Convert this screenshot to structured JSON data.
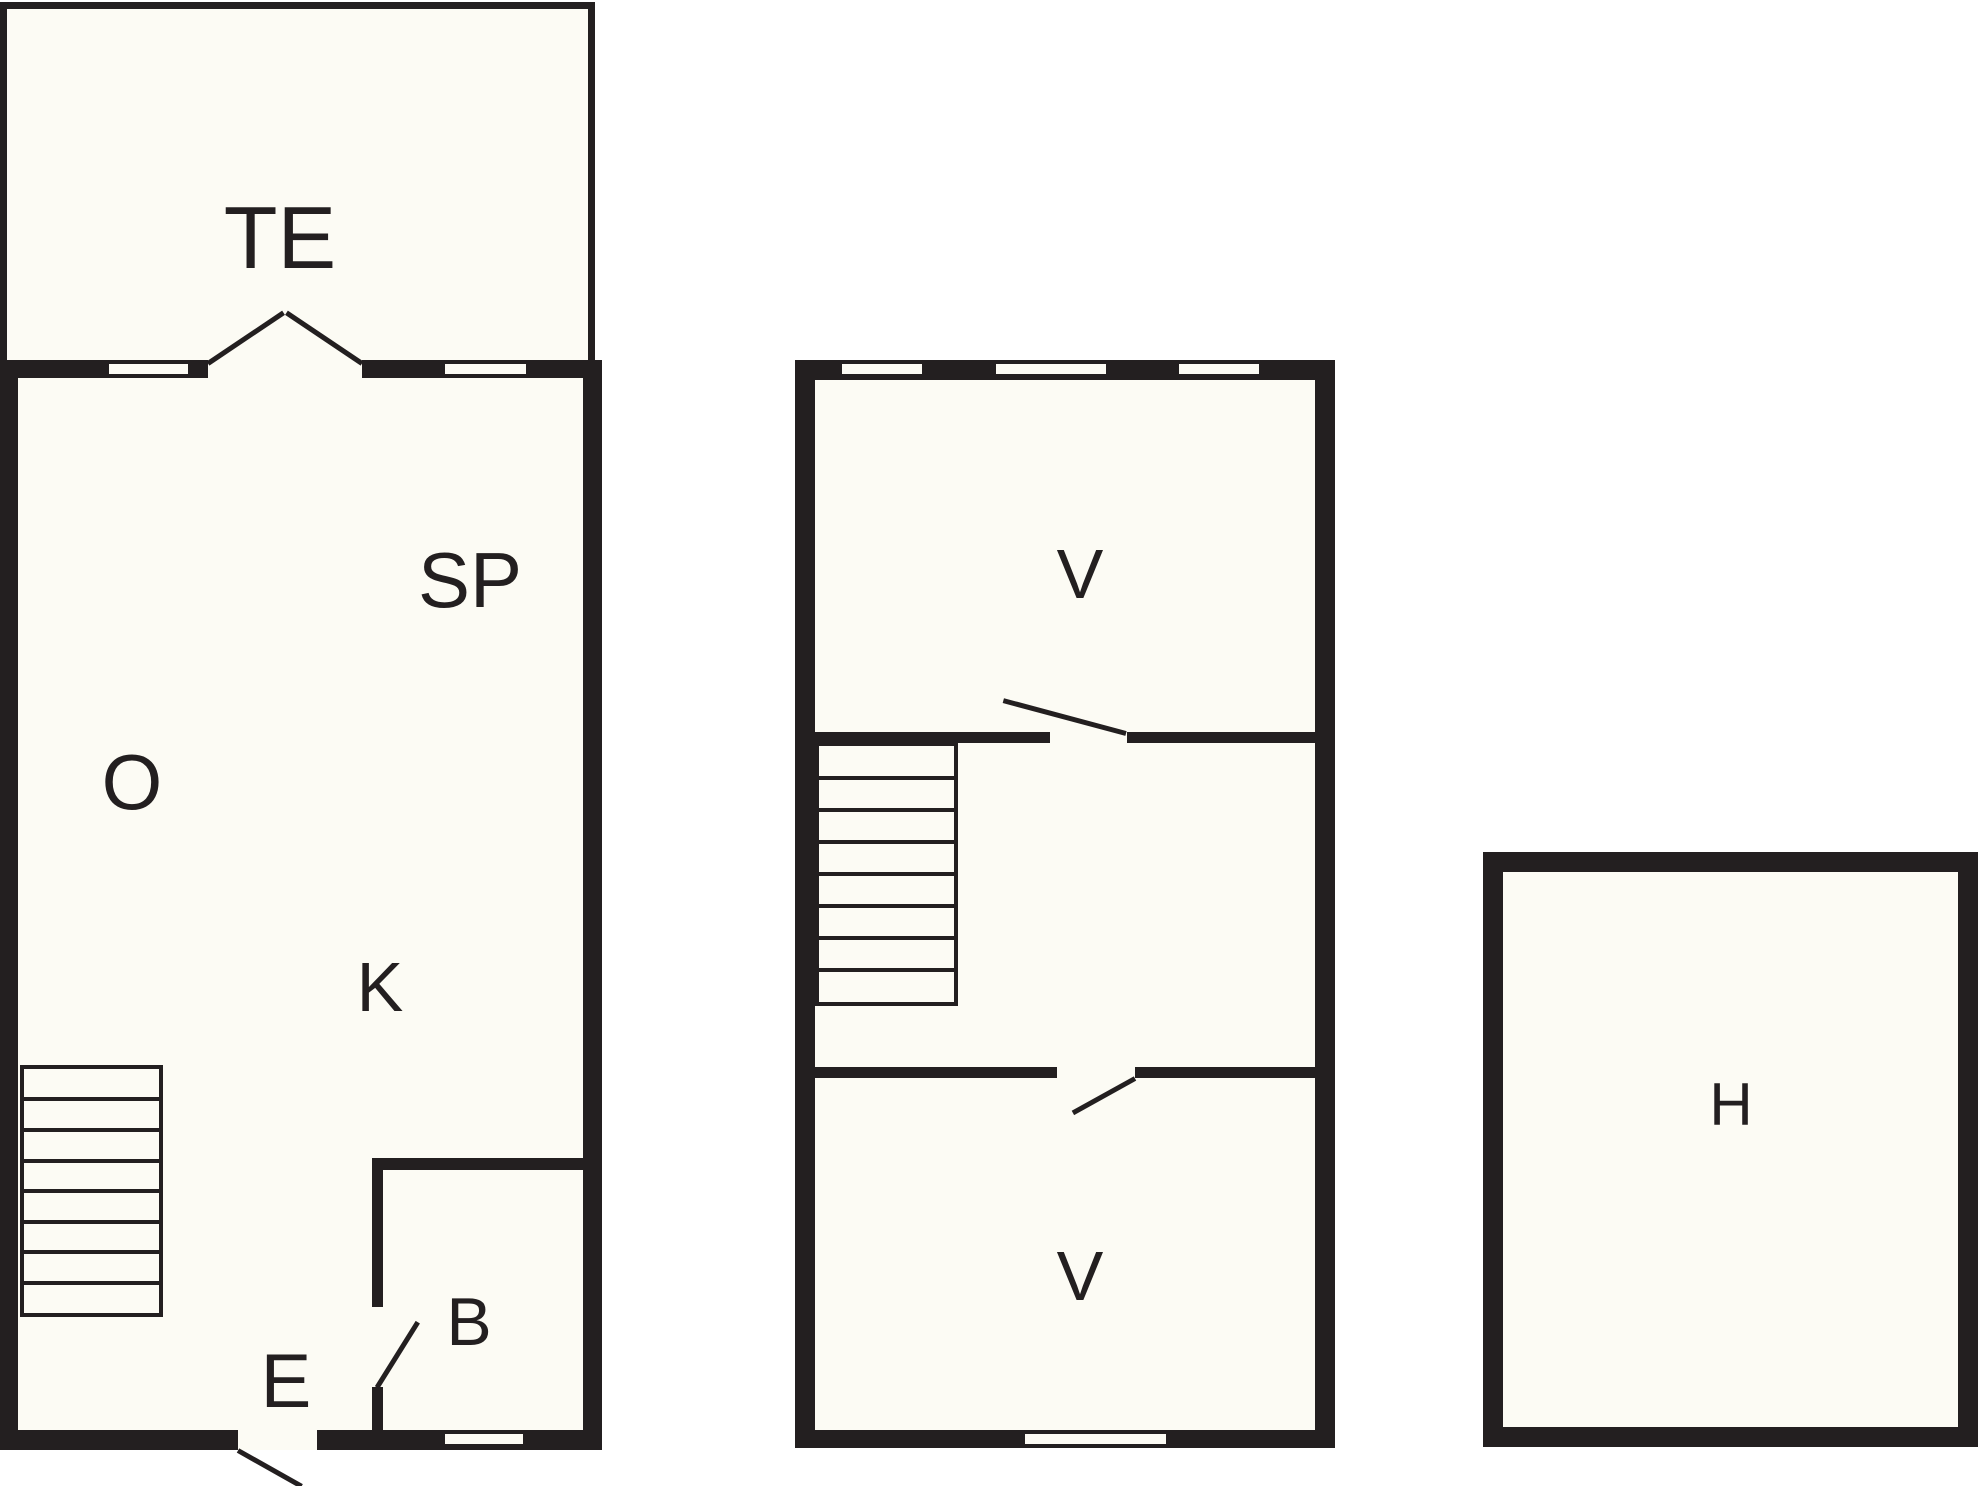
{
  "plan": {
    "title": "floor-plan",
    "rooms": {
      "te": "TE",
      "o": "O",
      "sp": "SP",
      "k": "K",
      "b": "B",
      "e": "E",
      "v_upper": "V",
      "v_lower": "V",
      "h": "H"
    },
    "colors": {
      "wall": "#231f20",
      "floor": "#fcfbf4",
      "background": "#ffffff"
    }
  }
}
